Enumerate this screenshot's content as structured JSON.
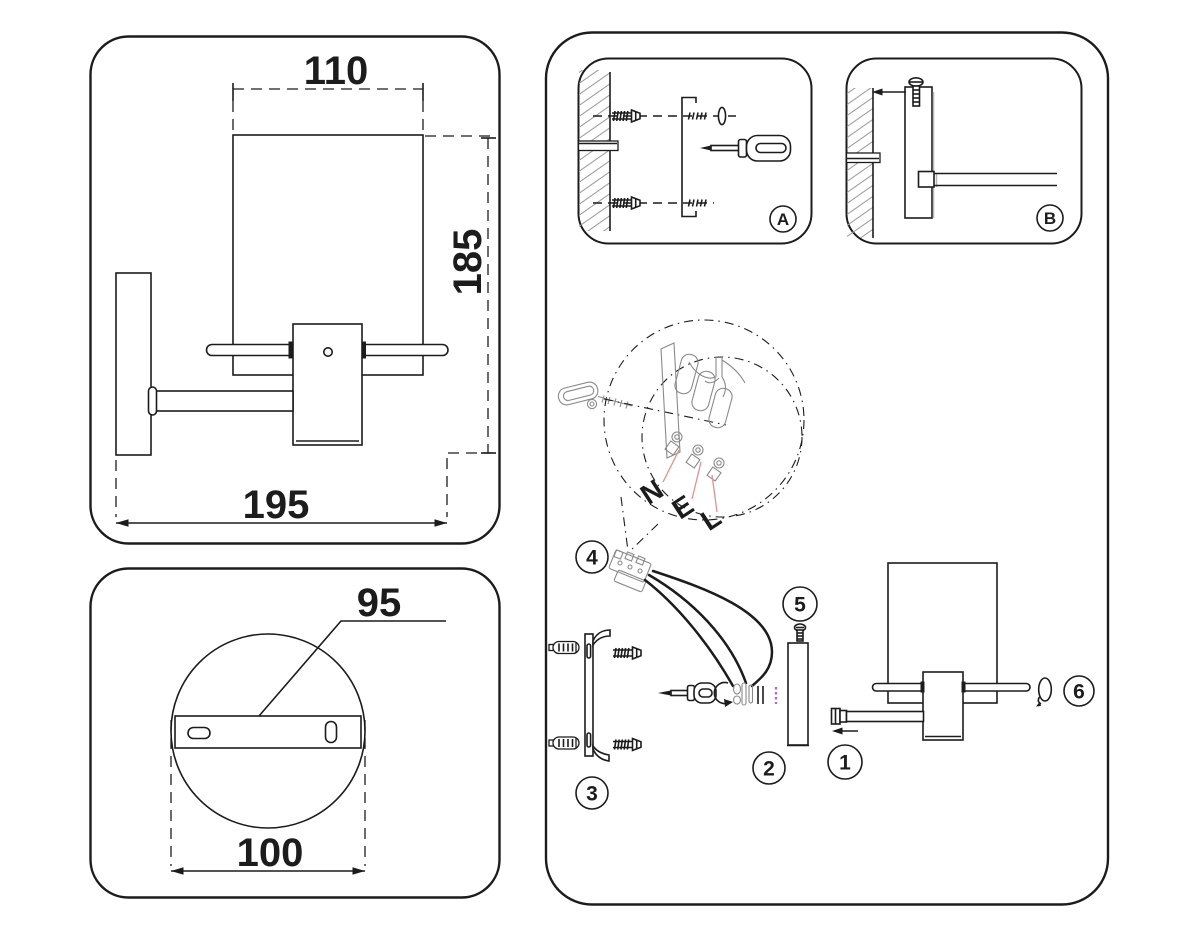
{
  "labels": {
    "dim_top_width": "110",
    "dim_height": "185",
    "dim_total_depth": "195",
    "dim_plate_leader": "95",
    "dim_plate_width": "100",
    "step_a": "A",
    "step_b": "B",
    "wire_neutral": "N",
    "wire_earth": "E",
    "wire_live": "L",
    "part_1": "1",
    "part_2": "2",
    "part_3": "3",
    "part_4": "4",
    "part_5": "5",
    "part_6": "6"
  },
  "colors": {
    "line": "#1c1c1c",
    "sketch": "#8a8a8a",
    "shadow": "#b5b5b5",
    "pink": "#e39090",
    "purple": "#b36bc6",
    "hatch": "#9a9a9a",
    "paper": "#ffffff"
  }
}
